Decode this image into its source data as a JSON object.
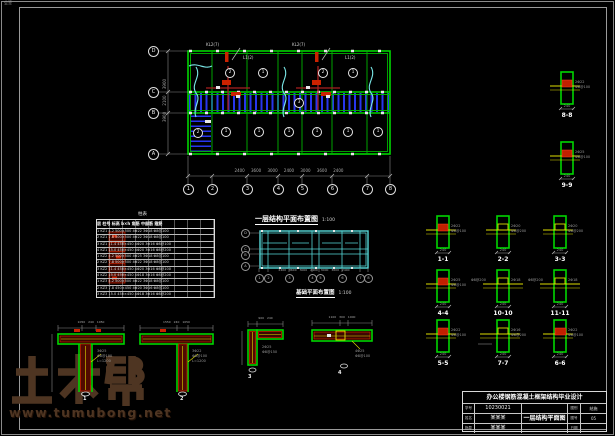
{
  "sheet": {
    "corner_note": "会签"
  },
  "watermark": {
    "brand": "土木帮",
    "site": "www.tumubong.net"
  },
  "main_plan": {
    "title": "一层结构平面布置图",
    "scale": "1:100",
    "axis_bottom": [
      "1",
      "2",
      "3",
      "4",
      "5",
      "6",
      "7",
      "8"
    ],
    "axis_left": [
      "D",
      "C",
      "B",
      "A"
    ],
    "dim_bottom": "2400 3600 3000 2400 3000 3600 2400",
    "dim_left": "3900 2100 3900",
    "slab_top": [
      "2",
      "1",
      "2",
      "1"
    ],
    "slab_bottom": [
      "1",
      "1",
      "1",
      "1",
      "1",
      "1"
    ],
    "corridor_slab": "3",
    "stair_slab": "2",
    "beam_notes": [
      "KL2(7)",
      "KL2(7)",
      "L1(2)",
      "L1(2)"
    ]
  },
  "column_table": {
    "title": "柱表",
    "header": "层 柱号 标高 b×h 角筋 中部筋 箍筋",
    "rows": [
      "1 KZ1 4.2 500×500 4Φ22 3Φ18 Φ8@100",
      "2 KZ1 7.8 500×500 4Φ22 3Φ18 Φ8@100",
      "3 KZ1 11.4 450×450 4Φ20 3Φ16 Φ8@100",
      "4 KZ1 15.0 450×450 4Φ20 3Φ16 Φ8@200",
      "1 KZ2 4.2 500×500 4Φ25 3Φ18 Φ8@100",
      "2 KZ2 7.8 500×500 4Φ22 3Φ18 Φ8@100",
      "3 KZ2 11.4 450×450 4Φ20 3Φ16 Φ8@100",
      "4 KZ2 15.0 450×450 4Φ18 3Φ16 Φ8@200",
      "1 KZ3 4.2 500×500 4Φ22 3Φ18 Φ8@100",
      "2 KZ3 7.8 450×450 4Φ20 3Φ16 Φ8@100",
      "3 KZ3 15.0 450×450 4Φ18 3Φ16 Φ8@200"
    ]
  },
  "foundation_plan": {
    "title": "基础平面布置图",
    "scale": "1:100",
    "axis_bottom": [
      "1",
      "2",
      "3",
      "4",
      "5",
      "6",
      "7",
      "8"
    ],
    "axis_left": [
      "D",
      "C",
      "B",
      "A"
    ],
    "dim_bottom": "2400 3600 3000 2400 3000 3600 2400"
  },
  "sections": [
    {
      "label": "1-1",
      "dim": "240",
      "note1": "2Φ22",
      "note2": "Φ8@100"
    },
    {
      "label": "2-2",
      "dim": "240",
      "note1": "2Φ20",
      "note2": "Φ8@200"
    },
    {
      "label": "3-3",
      "dim": "240",
      "note1": "2Φ20",
      "note2": "Φ8@200"
    },
    {
      "label": "4-4",
      "dim": "240",
      "note1": "2Φ25",
      "note2": "Φ8@100"
    },
    {
      "label": "10-10",
      "dim": "240",
      "note1": "2Φ18",
      "note2": "Φ8@200"
    },
    {
      "label": "11-11",
      "dim": "240",
      "note1": "2Φ18",
      "note2": "Φ8@200"
    },
    {
      "label": "5-5",
      "dim": "240",
      "note1": "2Φ22",
      "note2": "Φ8@100"
    },
    {
      "label": "7-7",
      "dim": "240",
      "note1": "2Φ16",
      "note2": "Φ8@200"
    },
    {
      "label": "6-6",
      "dim": "240",
      "note1": "2Φ22",
      "note2": "Φ8@100"
    },
    {
      "label": "8-8",
      "dim": "240",
      "note1": "2Φ22",
      "note2": "Φ8@100"
    },
    {
      "label": "9-9",
      "dim": "240",
      "note1": "2Φ25",
      "note2": "Φ8@100"
    }
  ],
  "details": [
    {
      "label": "1",
      "dim": "1050 240 1050",
      "note1": "3Φ25",
      "note2": "Φ8@100",
      "note3": "L=1200"
    },
    {
      "label": "2",
      "dim": "1550 240 1050",
      "note1": "3Φ22",
      "note2": "Φ8@100",
      "note3": "L=1200"
    },
    {
      "label": "3",
      "dim": "900 240",
      "note1": "2Φ25",
      "note2": "Φ8@150",
      "note3": ""
    },
    {
      "label": "4",
      "dim": "1100 300 1000",
      "note1": "4Φ25",
      "note2": "Φ8@100",
      "note3": ""
    }
  ],
  "title_block": {
    "project": "办公楼钢筋混凝土框架结构毕业设计",
    "rows": [
      {
        "label": "学号",
        "value": "10230021"
      },
      {
        "label": "姓名",
        "value": "某某某"
      },
      {
        "label": "指导",
        "value": "某某某"
      }
    ],
    "drawing_name": "一层结构平面图",
    "right_rows": [
      {
        "label": "图别",
        "value": "结施"
      },
      {
        "label": "图号",
        "value": "05"
      },
      {
        "label": "日期",
        "value": ""
      }
    ]
  }
}
